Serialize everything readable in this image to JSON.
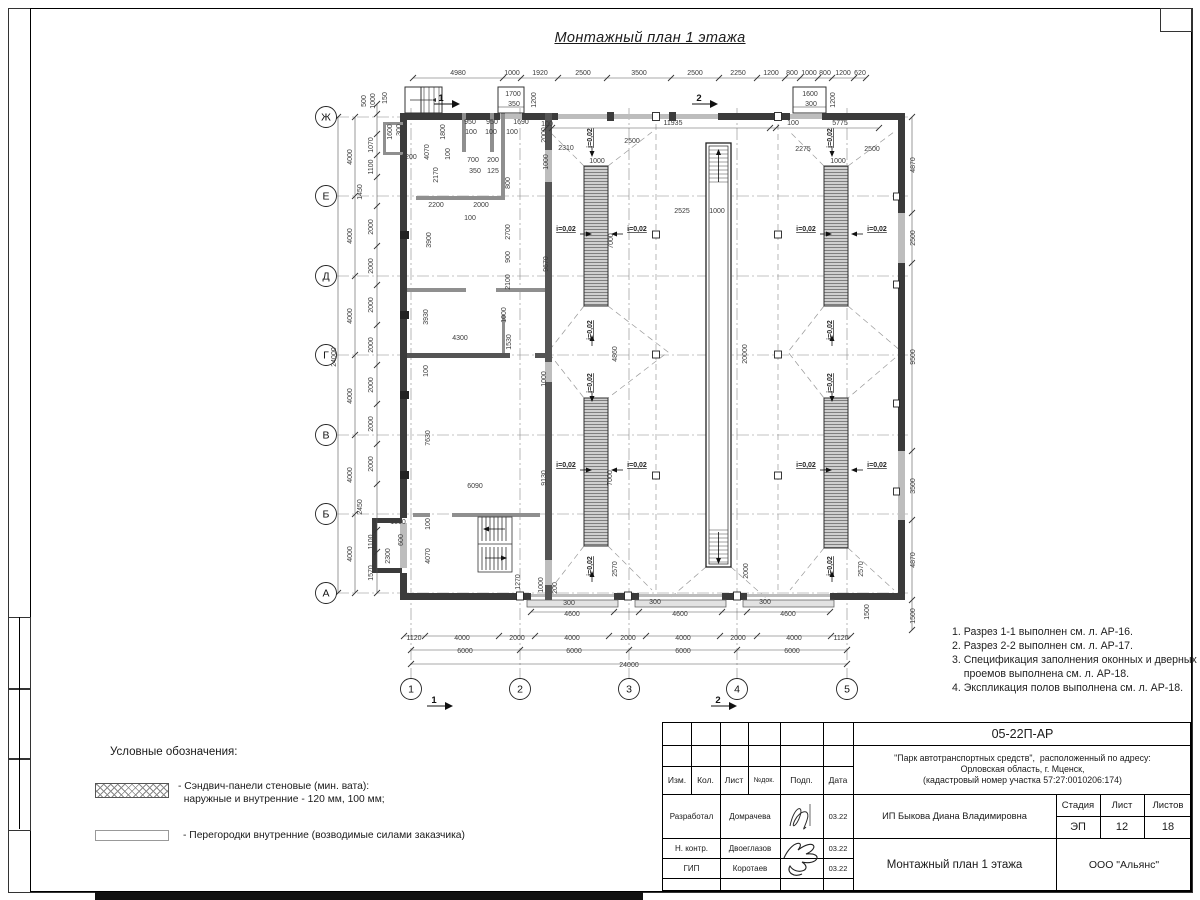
{
  "sheet": {
    "title": "Монтажный план 1 этажа",
    "notes": "1. Разрез 1-1 выполнен см. л. АР-16.\n2. Разрез 2-2 выполнен см. л. АР-17.\n3. Спецификация заполнения оконных и дверных\n    проемов выполнена см. л. АР-18.\n4. Экспликация полов выполнена см. л. АР-18."
  },
  "legend": {
    "heading": "Условные обозначения:",
    "items": [
      {
        "swatch": "crosshatch",
        "label": "- Сэндвич-панели стеновые (мин. вата):\n  наружные и внутренние - 120 мм, 100 мм;"
      },
      {
        "swatch": "plain",
        "label": "- Перегородки внутренние (возводимые силами заказчика)"
      }
    ]
  },
  "title_block": {
    "doc_number": "05-22П-АР",
    "project": "\"Парк автотранспортных средств\",  расположенный по адресу:\nОрловская область, г. Мценск,\n(кадастровый номер участка 57:27:0010206:174)",
    "client": "ИП Быкова Диана Владимировна",
    "sheet_title": "Монтажный план 1 этажа",
    "company": "ООО \"Альянс\"",
    "stage_label": "Стадия",
    "stage": "ЭП",
    "sheet_label": "Лист",
    "sheet_no": "12",
    "sheets_label": "Листов",
    "sheets_total": "18",
    "columns": [
      "Изм.",
      "Кол.",
      "Лист",
      "№док.",
      "Подп.",
      "Дата"
    ],
    "rows": [
      {
        "role": "Разработал",
        "name": "Домрачева",
        "date": "03.22"
      },
      {
        "role": "Н. контр.",
        "name": "Двоеглазов",
        "date": "03.22"
      },
      {
        "role": "ГИП",
        "name": "Коротаев",
        "date": "03.22"
      }
    ]
  },
  "plan": {
    "axes_rows": [
      "Ж",
      "Е",
      "Д",
      "Г",
      "В",
      "Б",
      "А"
    ],
    "axes_cols": [
      "1",
      "2",
      "3",
      "4",
      "5"
    ],
    "labels": [
      {
        "t": "4980",
        "x": 458,
        "y": 75
      },
      {
        "t": "1000",
        "x": 512,
        "y": 75
      },
      {
        "t": "1920",
        "x": 540,
        "y": 75
      },
      {
        "t": "2500",
        "x": 583,
        "y": 75
      },
      {
        "t": "3500",
        "x": 639,
        "y": 75
      },
      {
        "t": "2500",
        "x": 695,
        "y": 75
      },
      {
        "t": "2250",
        "x": 738,
        "y": 75
      },
      {
        "t": "1200",
        "x": 771,
        "y": 75
      },
      {
        "t": "800",
        "x": 792,
        "y": 75
      },
      {
        "t": "1000",
        "x": 809,
        "y": 75
      },
      {
        "t": "800",
        "x": 825,
        "y": 75
      },
      {
        "t": "1200",
        "x": 843,
        "y": 75
      },
      {
        "t": "620",
        "x": 860,
        "y": 75
      },
      {
        "t": "1700",
        "x": 513,
        "y": 96
      },
      {
        "t": "350",
        "x": 514,
        "y": 106
      },
      {
        "t": "1600",
        "x": 810,
        "y": 96
      },
      {
        "t": "300",
        "x": 811,
        "y": 106
      },
      {
        "t": "1200",
        "x": 536,
        "y": 100,
        "r": -90
      },
      {
        "t": "1200",
        "x": 835,
        "y": 100,
        "r": -90
      },
      {
        "t": "150",
        "x": 387,
        "y": 98,
        "r": -90
      },
      {
        "t": "500",
        "x": 366,
        "y": 101,
        "r": -90
      },
      {
        "t": "1000",
        "x": 375,
        "y": 101,
        "r": -90
      },
      {
        "t": "1",
        "x": 441,
        "y": 101,
        "cls": "sec"
      },
      {
        "t": "2",
        "x": 699,
        "y": 101,
        "cls": "sec"
      },
      {
        "t": "1",
        "x": 434,
        "y": 703,
        "cls": "sec"
      },
      {
        "t": "2",
        "x": 718,
        "y": 703,
        "cls": "sec"
      },
      {
        "t": "24000",
        "x": 336,
        "y": 357,
        "r": -90
      },
      {
        "t": "4000",
        "x": 352,
        "y": 157,
        "r": -90
      },
      {
        "t": "4000",
        "x": 352,
        "y": 236,
        "r": -90
      },
      {
        "t": "4000",
        "x": 352,
        "y": 316,
        "r": -90
      },
      {
        "t": "4000",
        "x": 352,
        "y": 396,
        "r": -90
      },
      {
        "t": "4000",
        "x": 352,
        "y": 475,
        "r": -90
      },
      {
        "t": "4000",
        "x": 352,
        "y": 554,
        "r": -90
      },
      {
        "t": "1070",
        "x": 373,
        "y": 145,
        "r": -90
      },
      {
        "t": "1100",
        "x": 373,
        "y": 167,
        "r": -90
      },
      {
        "t": "1450",
        "x": 362,
        "y": 192,
        "r": -90
      },
      {
        "t": "2000",
        "x": 373,
        "y": 227,
        "r": -90
      },
      {
        "t": "2000",
        "x": 373,
        "y": 266,
        "r": -90
      },
      {
        "t": "2000",
        "x": 373,
        "y": 305,
        "r": -90
      },
      {
        "t": "2000",
        "x": 373,
        "y": 345,
        "r": -90
      },
      {
        "t": "2000",
        "x": 373,
        "y": 385,
        "r": -90
      },
      {
        "t": "2000",
        "x": 373,
        "y": 424,
        "r": -90
      },
      {
        "t": "2000",
        "x": 373,
        "y": 464,
        "r": -90
      },
      {
        "t": "2450",
        "x": 362,
        "y": 507,
        "r": -90
      },
      {
        "t": "1100",
        "x": 373,
        "y": 542,
        "r": -90
      },
      {
        "t": "1570",
        "x": 373,
        "y": 573,
        "r": -90
      },
      {
        "t": "1600",
        "x": 392,
        "y": 132,
        "r": -90
      },
      {
        "t": "300",
        "x": 401,
        "y": 130,
        "r": -90
      },
      {
        "t": "1200",
        "x": 409,
        "y": 159
      },
      {
        "t": "950",
        "x": 470,
        "y": 124
      },
      {
        "t": "950",
        "x": 492,
        "y": 124
      },
      {
        "t": "1690",
        "x": 521,
        "y": 124
      },
      {
        "t": "100",
        "x": 547,
        "y": 126
      },
      {
        "t": "100",
        "x": 471,
        "y": 134
      },
      {
        "t": "100",
        "x": 491,
        "y": 134
      },
      {
        "t": "100",
        "x": 512,
        "y": 134
      },
      {
        "t": "1800",
        "x": 445,
        "y": 132,
        "r": -90
      },
      {
        "t": "2000",
        "x": 546,
        "y": 135,
        "r": -90
      },
      {
        "t": "1000",
        "x": 548,
        "y": 162,
        "r": -90
      },
      {
        "t": "4070",
        "x": 429,
        "y": 152,
        "r": -90
      },
      {
        "t": "2170",
        "x": 438,
        "y": 175,
        "r": -90
      },
      {
        "t": "100",
        "x": 450,
        "y": 154,
        "r": -90
      },
      {
        "t": "700",
        "x": 473,
        "y": 162
      },
      {
        "t": "200",
        "x": 493,
        "y": 162
      },
      {
        "t": "350",
        "x": 475,
        "y": 173
      },
      {
        "t": "125",
        "x": 493,
        "y": 173
      },
      {
        "t": "800",
        "x": 510,
        "y": 183,
        "r": -90
      },
      {
        "t": "2200",
        "x": 436,
        "y": 207
      },
      {
        "t": "2000",
        "x": 481,
        "y": 207
      },
      {
        "t": "100",
        "x": 470,
        "y": 220
      },
      {
        "t": "2700",
        "x": 510,
        "y": 232,
        "r": -90
      },
      {
        "t": "3900",
        "x": 431,
        "y": 240,
        "r": -90
      },
      {
        "t": "900",
        "x": 510,
        "y": 257,
        "r": -90
      },
      {
        "t": "2100",
        "x": 510,
        "y": 282,
        "r": -90
      },
      {
        "t": "9670",
        "x": 548,
        "y": 264,
        "r": -90
      },
      {
        "t": "3930",
        "x": 428,
        "y": 317,
        "r": -90
      },
      {
        "t": "1000",
        "x": 506,
        "y": 315,
        "r": -90
      },
      {
        "t": "4300",
        "x": 460,
        "y": 340
      },
      {
        "t": "1530",
        "x": 511,
        "y": 342,
        "r": -90
      },
      {
        "t": "100",
        "x": 428,
        "y": 371,
        "r": -90
      },
      {
        "t": "1000",
        "x": 546,
        "y": 379,
        "r": -90
      },
      {
        "t": "7630",
        "x": 430,
        "y": 438,
        "r": -90
      },
      {
        "t": "9130",
        "x": 546,
        "y": 478,
        "r": -90
      },
      {
        "t": "6090",
        "x": 475,
        "y": 488
      },
      {
        "t": "1500",
        "x": 398,
        "y": 524
      },
      {
        "t": "600",
        "x": 403,
        "y": 540,
        "r": -90
      },
      {
        "t": "2300",
        "x": 390,
        "y": 556,
        "r": -90
      },
      {
        "t": "100",
        "x": 430,
        "y": 524,
        "r": -90
      },
      {
        "t": "4070",
        "x": 430,
        "y": 556,
        "r": -90
      },
      {
        "t": "1270",
        "x": 520,
        "y": 582,
        "r": -90
      },
      {
        "t": "1000",
        "x": 543,
        "y": 585,
        "r": -90
      },
      {
        "t": "200",
        "x": 557,
        "y": 588,
        "r": -90
      },
      {
        "t": "300",
        "x": 569,
        "y": 605
      },
      {
        "t": "11935",
        "x": 673,
        "y": 125
      },
      {
        "t": "2310",
        "x": 566,
        "y": 150
      },
      {
        "t": "2500",
        "x": 632,
        "y": 143
      },
      {
        "t": "1000",
        "x": 597,
        "y": 163
      },
      {
        "t": "2525",
        "x": 682,
        "y": 213
      },
      {
        "t": "1000",
        "x": 717,
        "y": 213
      },
      {
        "t": "7000",
        "x": 613,
        "y": 241,
        "r": -90
      },
      {
        "t": "4860",
        "x": 617,
        "y": 354,
        "r": -90
      },
      {
        "t": "20000",
        "x": 747,
        "y": 354,
        "r": -90
      },
      {
        "t": "7000",
        "x": 612,
        "y": 478,
        "r": -90
      },
      {
        "t": "2570",
        "x": 617,
        "y": 569,
        "r": -90
      },
      {
        "t": "2000",
        "x": 748,
        "y": 571,
        "r": -90
      },
      {
        "t": "100",
        "x": 793,
        "y": 125
      },
      {
        "t": "5775",
        "x": 840,
        "y": 125
      },
      {
        "t": "2275",
        "x": 803,
        "y": 151
      },
      {
        "t": "2500",
        "x": 872,
        "y": 151
      },
      {
        "t": "1000",
        "x": 838,
        "y": 163
      },
      {
        "t": "2570",
        "x": 863,
        "y": 569,
        "r": -90
      },
      {
        "t": "i=0,02",
        "x": 592,
        "y": 138,
        "r": -90,
        "u": 1,
        "d": "d"
      },
      {
        "t": "i=0,02",
        "x": 592,
        "y": 330,
        "r": -90,
        "u": 1,
        "d": "u"
      },
      {
        "t": "i=0,02",
        "x": 592,
        "y": 383,
        "r": -90,
        "u": 1,
        "d": "d"
      },
      {
        "t": "i=0,02",
        "x": 592,
        "y": 566,
        "r": -90,
        "u": 1,
        "d": "u"
      },
      {
        "t": "i=0,02",
        "x": 832,
        "y": 138,
        "r": -90,
        "u": 1,
        "d": "d"
      },
      {
        "t": "i=0,02",
        "x": 832,
        "y": 330,
        "r": -90,
        "u": 1,
        "d": "u"
      },
      {
        "t": "i=0,02",
        "x": 832,
        "y": 383,
        "r": -90,
        "u": 1,
        "d": "d"
      },
      {
        "t": "i=0,02",
        "x": 832,
        "y": 566,
        "r": -90,
        "u": 1,
        "d": "u"
      },
      {
        "t": "i=0,02",
        "x": 566,
        "y": 231,
        "u": 1,
        "d": "r"
      },
      {
        "t": "i=0,02",
        "x": 637,
        "y": 231,
        "u": 1,
        "d": "l"
      },
      {
        "t": "i=0,02",
        "x": 806,
        "y": 231,
        "u": 1,
        "d": "r"
      },
      {
        "t": "i=0,02",
        "x": 877,
        "y": 231,
        "u": 1,
        "d": "l"
      },
      {
        "t": "i=0,02",
        "x": 566,
        "y": 467,
        "u": 1,
        "d": "r"
      },
      {
        "t": "i=0,02",
        "x": 637,
        "y": 467,
        "u": 1,
        "d": "l"
      },
      {
        "t": "i=0,02",
        "x": 806,
        "y": 467,
        "u": 1,
        "d": "r"
      },
      {
        "t": "i=0,02",
        "x": 877,
        "y": 467,
        "u": 1,
        "d": "l"
      },
      {
        "t": "4870",
        "x": 915,
        "y": 165,
        "r": -90
      },
      {
        "t": "2500",
        "x": 915,
        "y": 238,
        "r": -90
      },
      {
        "t": "9500",
        "x": 915,
        "y": 357,
        "r": -90
      },
      {
        "t": "3500",
        "x": 915,
        "y": 486,
        "r": -90
      },
      {
        "t": "4870",
        "x": 915,
        "y": 560,
        "r": -90
      },
      {
        "t": "1500",
        "x": 915,
        "y": 616,
        "r": -90
      },
      {
        "t": "300",
        "x": 655,
        "y": 604
      },
      {
        "t": "300",
        "x": 765,
        "y": 604
      },
      {
        "t": "4600",
        "x": 572,
        "y": 616
      },
      {
        "t": "4600",
        "x": 680,
        "y": 616
      },
      {
        "t": "4600",
        "x": 788,
        "y": 616
      },
      {
        "t": "1500",
        "x": 869,
        "y": 612,
        "r": -90
      },
      {
        "t": "1120",
        "x": 414,
        "y": 640
      },
      {
        "t": "4000",
        "x": 462,
        "y": 640
      },
      {
        "t": "2000",
        "x": 517,
        "y": 640
      },
      {
        "t": "4000",
        "x": 572,
        "y": 640
      },
      {
        "t": "2000",
        "x": 628,
        "y": 640
      },
      {
        "t": "4000",
        "x": 683,
        "y": 640
      },
      {
        "t": "2000",
        "x": 738,
        "y": 640
      },
      {
        "t": "4000",
        "x": 794,
        "y": 640
      },
      {
        "t": "1120",
        "x": 841,
        "y": 640
      },
      {
        "t": "6000",
        "x": 465,
        "y": 653
      },
      {
        "t": "6000",
        "x": 574,
        "y": 653
      },
      {
        "t": "6000",
        "x": 683,
        "y": 653
      },
      {
        "t": "6000",
        "x": 792,
        "y": 653
      },
      {
        "t": "24000",
        "x": 629,
        "y": 667
      }
    ]
  }
}
